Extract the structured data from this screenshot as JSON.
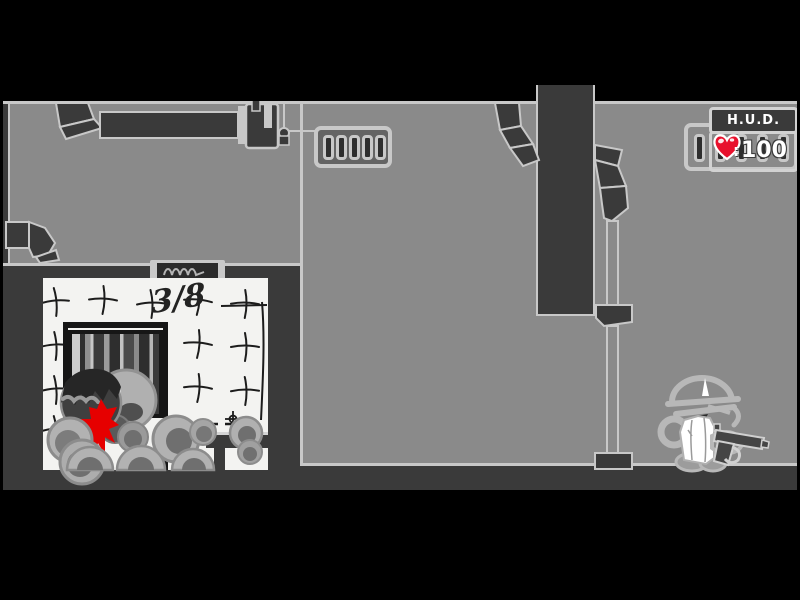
{
  "game": {
    "hud": {
      "title": "H.U.D.",
      "separator": ":",
      "health": "100"
    },
    "wall_graffiti": "3/8"
  },
  "icons": {
    "heart": "heart-icon",
    "vent": "vent-grill-icon",
    "pistol": "pistol-icon",
    "sign_squiggle": "scribble-sign-icon"
  },
  "colors": {
    "letterbox": "#000000",
    "room_gray": "#8a8a8a",
    "dark_structure": "#3a3a3a",
    "outline_light": "#c8c8c8",
    "white_room": "#f3f3f1",
    "blood_red": "#e60000",
    "heart_red": "#e8112d",
    "hud_text": "#ffffff",
    "sketch_ink": "#1c1c1c"
  }
}
